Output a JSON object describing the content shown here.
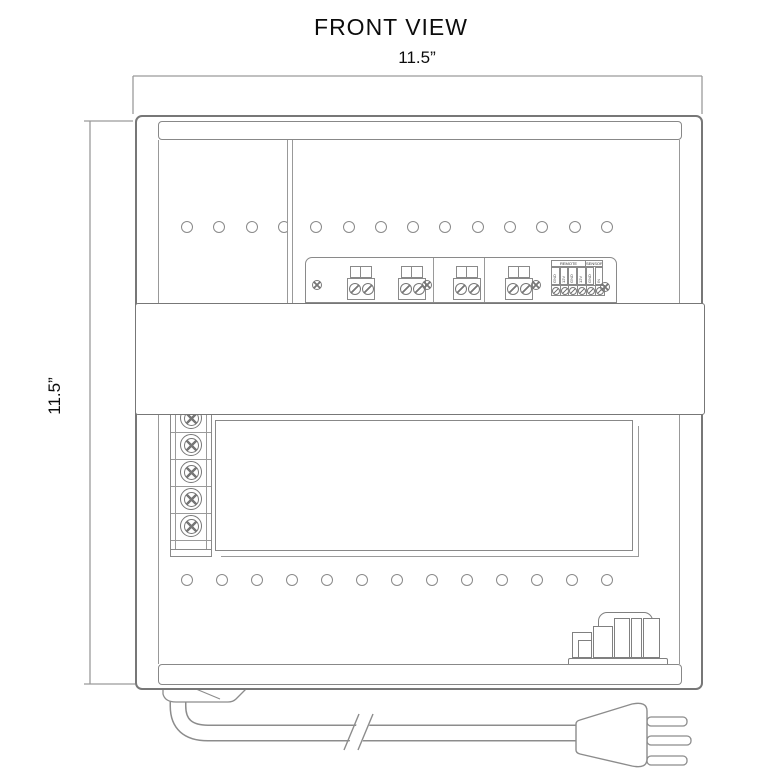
{
  "title": "FRONT VIEW",
  "dimensions": {
    "width": "11.5”",
    "height": "11.5”"
  },
  "vents": {
    "top_count": 14,
    "bottom_count": 13
  },
  "terminal_panel": {
    "block_count": 4,
    "strip": {
      "headers": [
        "REMOTE",
        "SENSOR"
      ],
      "pins": [
        "GND",
        "12V",
        "GND",
        "12V",
        "GND",
        "IN"
      ]
    }
  },
  "left_terminal": {
    "screw_count": 5
  },
  "power_plug": {
    "prong_count": 3
  },
  "colors": {
    "line": "#8a8a8a",
    "text": "#111111"
  }
}
